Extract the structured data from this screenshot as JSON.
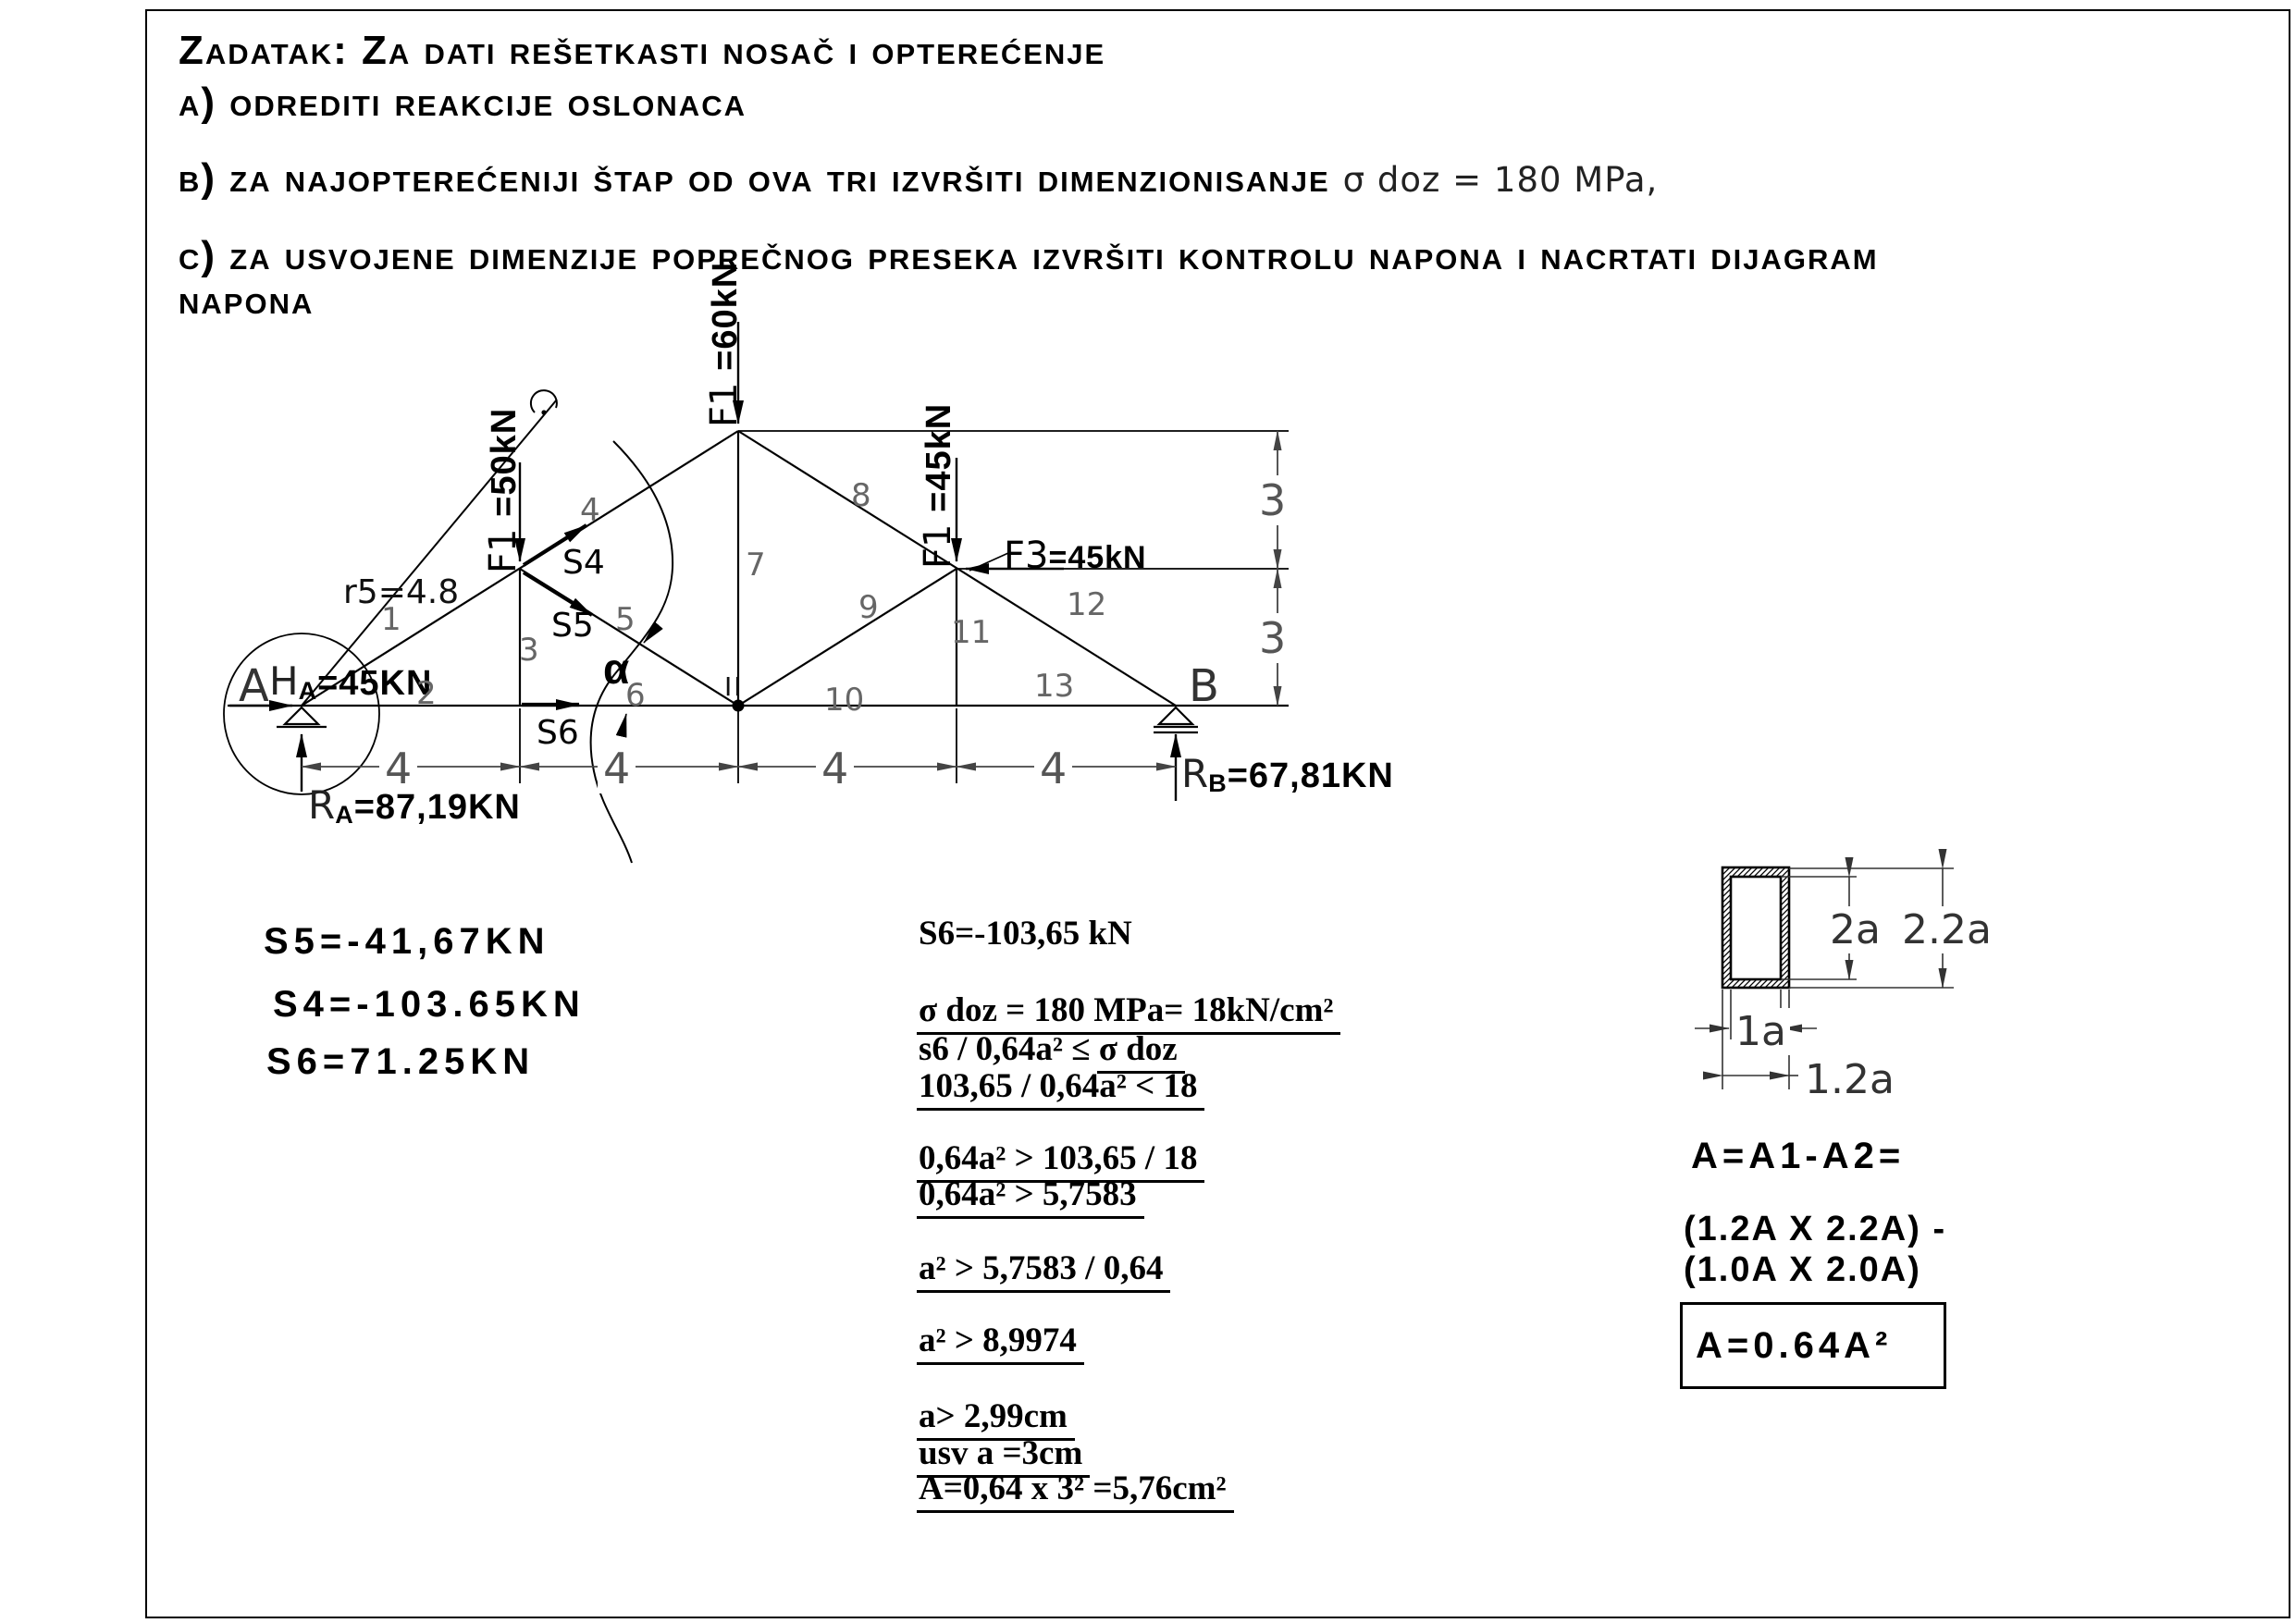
{
  "header": {
    "title": "Zadatak: Za dati rešetkasti nosač i opterećenje",
    "item_a": "a) odrediti reakcije oslonaca",
    "item_b": "b) za najopterećeniji štap od ova tri izvršiti dimenzionisanje",
    "item_b_note": "σ doz = 180 MPa,",
    "item_c_line1": "c) za usvojene dimenzije poprečnog preseka izvršiti kontrolu napona i nacrtati dijagram",
    "item_c_line2": "napona"
  },
  "truss": {
    "support_a": "A",
    "support_b": "B",
    "node_ii": "II",
    "alpha": "α",
    "r5": "r5=4.8",
    "member_labels": [
      "1",
      "2",
      "3",
      "4",
      "5",
      "6",
      "7",
      "8",
      "9",
      "10",
      "11",
      "12",
      "13"
    ],
    "dim_h": [
      "4",
      "4",
      "4",
      "4"
    ],
    "dim_v": [
      "3",
      "3"
    ],
    "forces": {
      "f_top": {
        "name": "F1 ",
        "value": "=60kN"
      },
      "f_mid": {
        "name": "F1 ",
        "value": "=50kN"
      },
      "f_right": {
        "name": "F1 ",
        "value": "=45kN"
      },
      "f3": {
        "name": "F3",
        "value": "=45kN"
      },
      "ha": {
        "name": "H",
        "sub": "A",
        "value": "=45KN"
      },
      "ra": {
        "name": "R",
        "sub": "A",
        "value": "=87,19KN"
      },
      "rb": {
        "name": "R",
        "sub": "B",
        "value": "=67,81KN"
      }
    },
    "section_labels": {
      "s4": "S4",
      "s5": "S5",
      "s6": "S6"
    }
  },
  "results": [
    "S5=-41,67KN",
    "S4=-103.65KN",
    "S6=71.25KN"
  ],
  "calc_lines": [
    {
      "parts": [
        {
          "t": "S6=-103,65 kN",
          "u": false
        }
      ]
    },
    {
      "parts": [
        {
          "t": "σ doz = 180 MPa= 18kN/cm²",
          "u": true
        }
      ]
    },
    {
      "parts": [
        {
          "t": "s6 / 0,64a² ≤ ",
          "u": false
        },
        {
          "t": "σ doz",
          "u": true
        }
      ]
    },
    {
      "parts": [
        {
          "t": "103,65 / 0,64a² < 18",
          "u": true
        }
      ]
    },
    {
      "parts": [
        {
          "t": "0,64a² > 103,65 / 18",
          "u": true
        }
      ]
    },
    {
      "parts": [
        {
          "t": "0,64a² > 5,7583",
          "u": true
        }
      ]
    },
    {
      "parts": [
        {
          "t": "a² > 5,7583 / 0,64",
          "u": true
        }
      ]
    },
    {
      "parts": [
        {
          "t": "a² > 8,9974",
          "u": true
        }
      ]
    },
    {
      "parts": [
        {
          "t": "a> 2,99cm",
          "u": true
        }
      ]
    },
    {
      "parts": [
        {
          "t": "usv a =3cm",
          "u": true
        }
      ]
    },
    {
      "parts": [
        {
          "t": "A=0,64  x 3² =5,76cm²",
          "u": true
        }
      ]
    }
  ],
  "cross_section": {
    "dim_2a": "2a",
    "dim_22a": "2.2a",
    "dim_1a": "1a",
    "dim_12a": "1.2a"
  },
  "area": {
    "line1": "A=A1-A2=",
    "line2": "(1.2A X 2.2A) -",
    "line3": "(1.0A X 2.0A)",
    "boxed": "A=0.64A²"
  }
}
